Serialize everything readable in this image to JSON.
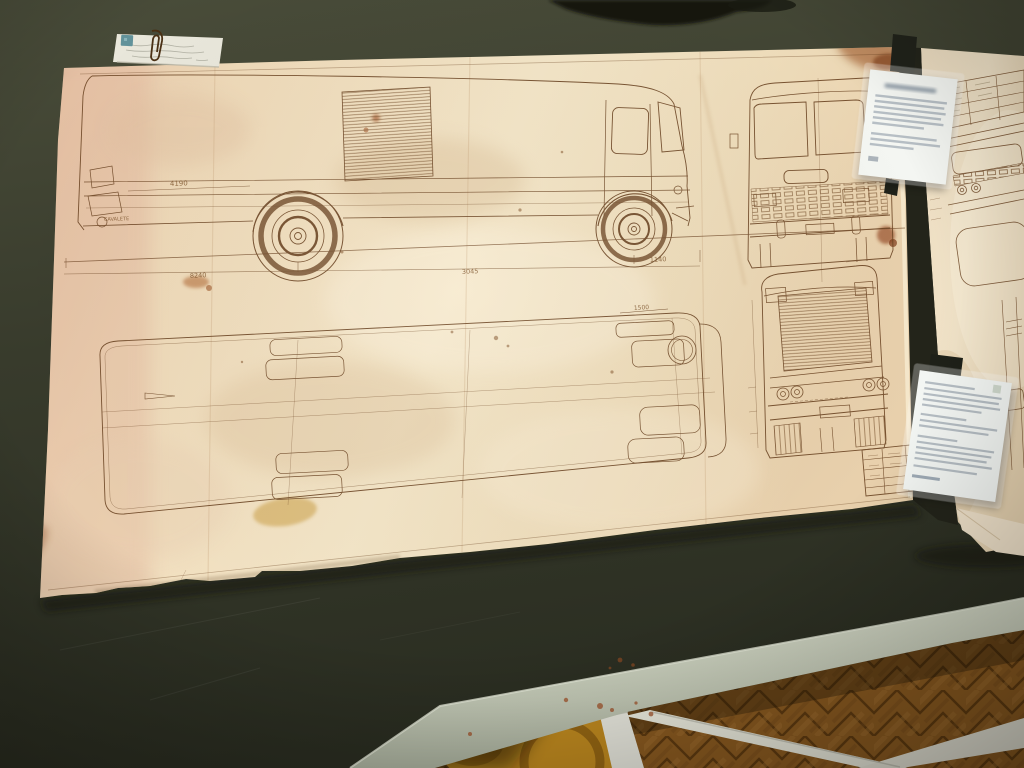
{
  "scene": {
    "setting": "archive-room table with vintage bus blueprints",
    "table_color": "#3a3d2d",
    "table_edge_color": "#c6ccba",
    "floor_color": "#8a5a20",
    "paper_color": "#eed9ba",
    "ink_color": "#6b4423",
    "accent_sticker_color": "#62929a"
  },
  "blueprint": {
    "subject": "coach bus technical drawing",
    "views": [
      "side elevation",
      "front elevation",
      "rear elevation",
      "roof plan"
    ],
    "annotations": [
      "4190",
      "8240",
      "3045",
      "1140",
      "1500",
      "CAVALETE"
    ],
    "attachments": {
      "note": "handwritten note held by paperclip",
      "sticker": "small blue square sticker"
    },
    "title_block_legible": false
  },
  "secondary_sheet": {
    "content": "specification table and partial bus front elevation",
    "legible": false
  },
  "labels": [
    {
      "name": "exhibit label card (upper)",
      "legible": false
    },
    {
      "name": "exhibit label card (lower)",
      "legible": false
    }
  ]
}
